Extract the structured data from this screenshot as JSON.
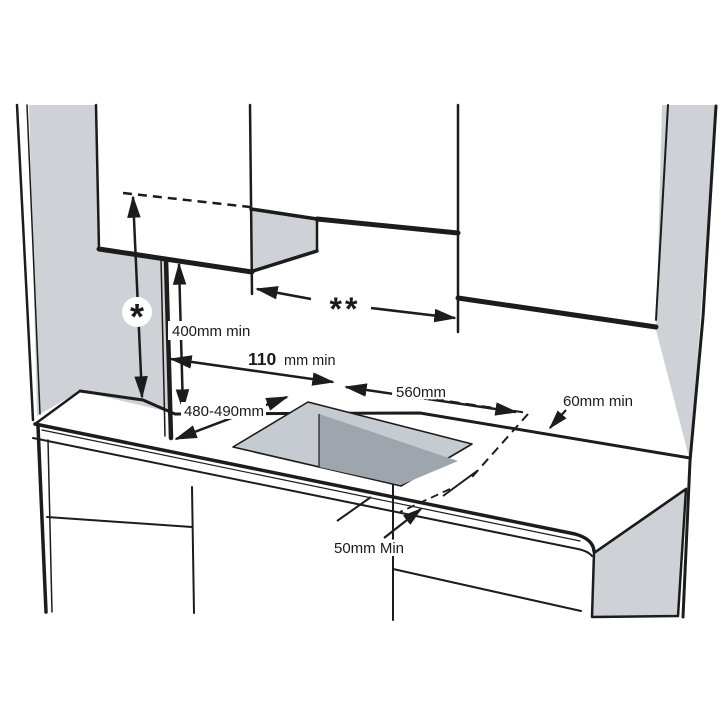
{
  "diagram": {
    "colors": {
      "background": "#ffffff",
      "line": "#1c1c1c",
      "wall_gray": "#ced2d7",
      "cutout_light": "#c6cbd1",
      "cutout_dark": "#9ea5ad",
      "label_text": "#1a1a1a",
      "badge_bg": "#ffffff"
    },
    "labels": {
      "hood_height_symbol": "*",
      "cabinet_gap_symbol": "**",
      "worktop_to_cabinet": "400mm min",
      "side_clearance_value": "110",
      "side_clearance_unit": "mm min",
      "cutout_width": "560mm",
      "cutout_depth": "480-490mm",
      "rear_clearance": "60mm min",
      "front_clearance": "50mm Min"
    }
  }
}
